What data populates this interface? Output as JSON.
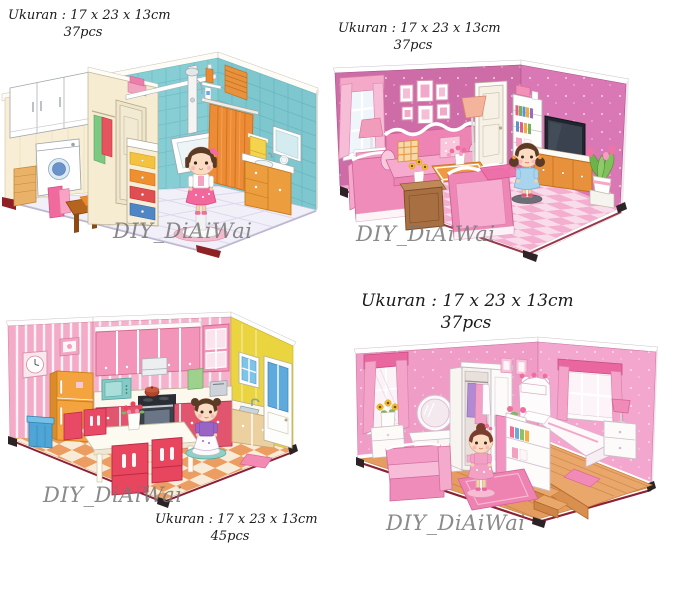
{
  "page": {
    "background": "#ffffff",
    "text_color": "#1b1b1b",
    "watermark_color": "#767676"
  },
  "products": [
    {
      "name": "bathroom-laundry-room",
      "size_label": "Ukuran : 17 x 23 x 13cm",
      "pieces_label": "37pcs",
      "watermark": "DIY_DiAiWai"
    },
    {
      "name": "living-room",
      "size_label": "Ukuran : 17 x 23 x 13cm",
      "pieces_label": "37pcs",
      "watermark": "DIY_DiAiWai"
    },
    {
      "name": "kitchen",
      "size_label": "Ukuran : 17 x 23 x 13cm",
      "pieces_label": "45pcs",
      "watermark": "DIY_DiAiWai"
    },
    {
      "name": "bedroom",
      "size_label": "Ukuran : 17 x 23 x 13cm",
      "pieces_label": "37pcs",
      "watermark": "DIY_DiAiWai"
    }
  ],
  "colors": {
    "wall_cream": "#f8eed5",
    "wall_teal": "#87cdd4",
    "wall_magenta": "#ce6ca7",
    "wall_pink_striped": "#f4abc7",
    "wall_yellow": "#ead43f",
    "wall_pink_dotted": "#ef9cc6",
    "floor_wood": "#e59c60",
    "floor_pink_checker": "#f3aed0",
    "floor_orange_checker": "#eb9d62",
    "base_trim_red": "#8c2135"
  }
}
